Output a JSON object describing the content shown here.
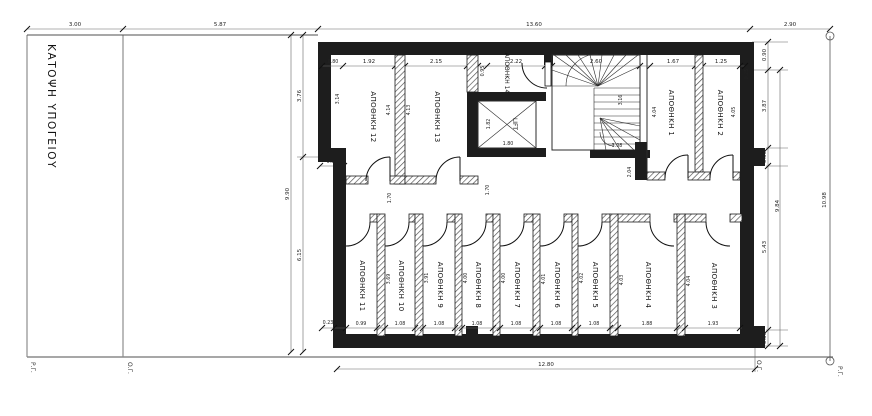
{
  "title": "ΚΑΤΟΨΗ ΥΠΟΓΕΙΟΥ",
  "boundary_labels": {
    "pg_left": "Ρ.Γ.",
    "og_left": "Ο.Γ.",
    "og_right": "Ο.Γ.",
    "pg_right": "Ρ.Γ."
  },
  "rooms": {
    "r1": "ΑΠΟΘΗΚΗ 1",
    "r2": "ΑΠΟΘΗΚΗ 2",
    "r3": "ΑΠΟΘΗΚΗ 3",
    "r4": "ΑΠΟΘΗΚΗ 4",
    "r5": "ΑΠΟΘΗΚΗ 5",
    "r6": "ΑΠΟΘΗΚΗ 6",
    "r7": "ΑΠΟΘΗΚΗ 7",
    "r8": "ΑΠΟΘΗΚΗ 8",
    "r9": "ΑΠΟΘΗΚΗ 9",
    "r10": "ΑΠΟΘΗΚΗ 10",
    "r11": "ΑΠΟΘΗΚΗ 11",
    "r12": "ΑΠΟΘΗΚΗ 12",
    "r13": "ΑΠΟΘΗΚΗ 13",
    "r14": "ΑΠΟΘΗΚΗ 14",
    "lift": "LIFT"
  },
  "dims": {
    "site": {
      "left": "3.00",
      "yard": "5.87",
      "building": "13.60",
      "right": "2.90",
      "bottom_building": "12.80",
      "right_total": "10.98"
    },
    "left": {
      "total": "9.90",
      "upper": "3.76",
      "lower": "6.15",
      "step": "0.80"
    },
    "right": {
      "seg1": "0.90",
      "seg2": "3.87",
      "seg3": "0.55",
      "seg4": "5.43",
      "seg5": "0.50",
      "inner_total": "9.84"
    },
    "top_band": {
      "wall": "0.80",
      "r12_w": "1.92",
      "r13_w": "2.15",
      "r14_w": "2.22",
      "stair_w": "2.60",
      "r1_w": "1.67",
      "r2_w": "1.25",
      "wall_r": "0.25",
      "r12_h": "3.14",
      "r12_hr": "4.14",
      "r13_h": "4.13",
      "r14_h": "0.95",
      "r1_h": "4.04",
      "r2_h": "4.05"
    },
    "core": {
      "lift_w": "1.80",
      "lift_h": "1.82",
      "stair_w": "3.08",
      "stair_h": "3.16",
      "corr_a": "1.70",
      "corr_b": "1.70",
      "corr_r": "2.04"
    },
    "bottom_band": {
      "wall": "0.23",
      "r11_w": "0.99",
      "r10_w": "1.08",
      "r9_w": "1.08",
      "r8_w": "1.08",
      "r7_w": "1.08",
      "r6_w": "1.08",
      "r5_w": "1.08",
      "r4_w": "1.88",
      "r3_w": "1.93",
      "r10_h": "3.69",
      "r9_h": "3.91",
      "r8_h": "4.00",
      "r7_h": "4.00",
      "r6_h": "4.01",
      "r5_h": "4.02",
      "r4_h": "4.03",
      "r3_h": "4.04"
    }
  }
}
